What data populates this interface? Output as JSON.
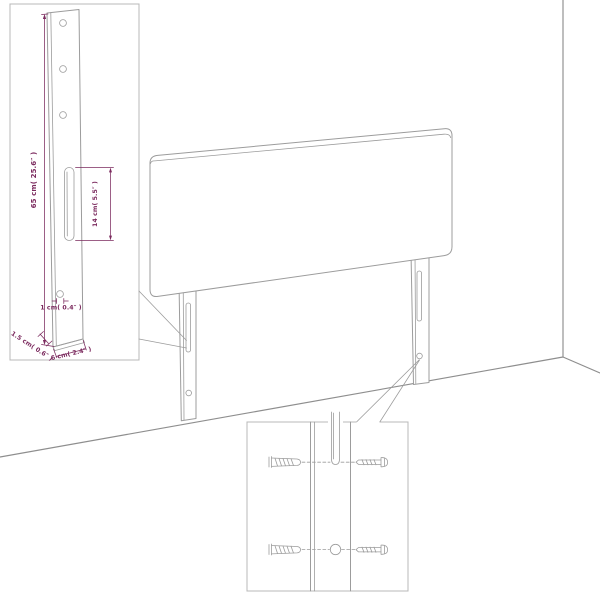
{
  "diagram": {
    "type": "product-assembly-dimension-diagram",
    "subject": "upholstered headboard with two mounting legs, wall corner perspective, dimension inset and wall-mounting hardware inset"
  },
  "labels": {
    "post_height": "65 cm( 25.6″ )",
    "slot_length": "14 cm( 5.5″ )",
    "hole_diameter": "1 cm( 0.4″ )",
    "post_depth": "1.5 cm( 0.6″ )",
    "post_width": "6 cm( 2.4″ )"
  },
  "icons": {
    "wall_plug": "wall-plug-icon",
    "screw": "screw-icon"
  },
  "colors": {
    "background": "#ffffff",
    "line": "#9c9c9c",
    "wall": "#8e8e8e",
    "dimension": "#7b2a5e",
    "inset_border": "#b8b8b8"
  }
}
